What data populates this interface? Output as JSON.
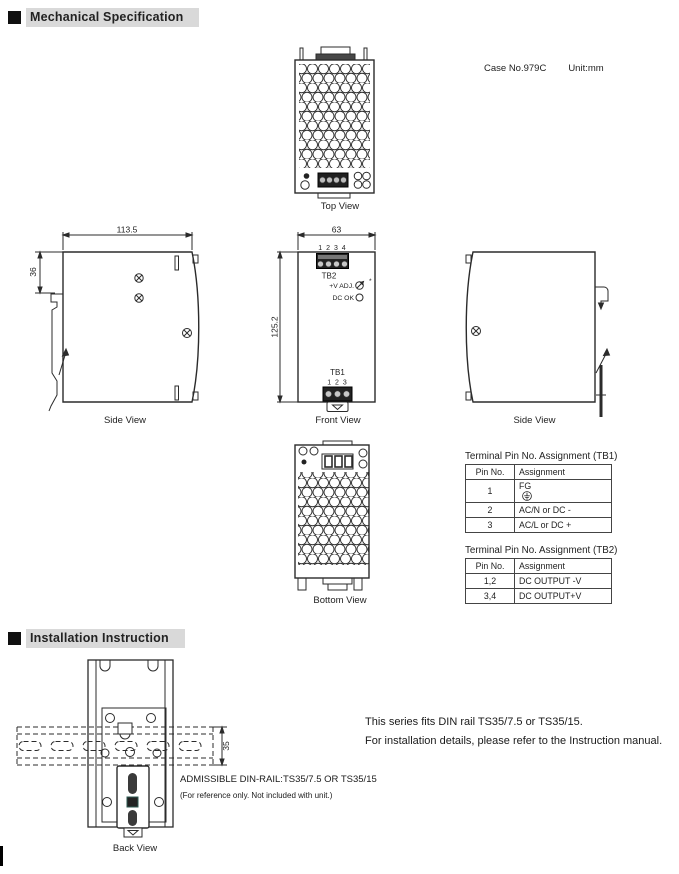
{
  "sections": {
    "mechanical": {
      "title": "Mechanical Specification"
    },
    "installation": {
      "title": "Installation Instruction"
    }
  },
  "mechanical": {
    "case_no": "Case No.979C",
    "unit": "Unit:mm",
    "view_labels": {
      "top": "Top View",
      "side_left": "Side View",
      "front": "Front View",
      "side_right": "Side View",
      "bottom": "Bottom View"
    },
    "dims": {
      "body_width": "113.5",
      "clip_depth": "36",
      "front_width": "63",
      "body_height": "125.2"
    },
    "front": {
      "tb2_pins": "1 2 3 4",
      "tb2": "TB2",
      "v_adj": "+V ADJ.",
      "v_adj_star": "*",
      "dc_ok": "DC OK",
      "tb1": "TB1",
      "tb1_pins": "1 2 3"
    },
    "tb1_table": {
      "title": "Terminal Pin No.  Assignment (TB1)",
      "col_pin": "Pin No.",
      "col_assign": "Assignment",
      "rows": [
        {
          "pin": "1",
          "assign": "FG"
        },
        {
          "pin": "2",
          "assign": "AC/N or DC -"
        },
        {
          "pin": "3",
          "assign": "AC/L or DC +"
        }
      ]
    },
    "tb2_table": {
      "title": "Terminal Pin No.  Assignment (TB2)",
      "col_pin": "Pin No.",
      "col_assign": "Assignment",
      "rows": [
        {
          "pin": "1,2",
          "assign": "DC OUTPUT -V"
        },
        {
          "pin": "3,4",
          "assign": "DC OUTPUT+V"
        }
      ]
    }
  },
  "installation": {
    "back_view_label": "Back View",
    "rail_dim": "35",
    "fit_note_line1": "This series fits DIN rail TS35/7.5 or TS35/15.",
    "fit_note_line2": "For installation details, please refer to the Instruction manual.",
    "admissible": "ADMISSIBLE DIN-RAIL:TS35/7.5 OR TS35/15",
    "reference_note": "(For reference only. Not included with unit.)"
  },
  "colors": {
    "line": "#2b2b2b",
    "header_bg": "#d9d9d9"
  }
}
